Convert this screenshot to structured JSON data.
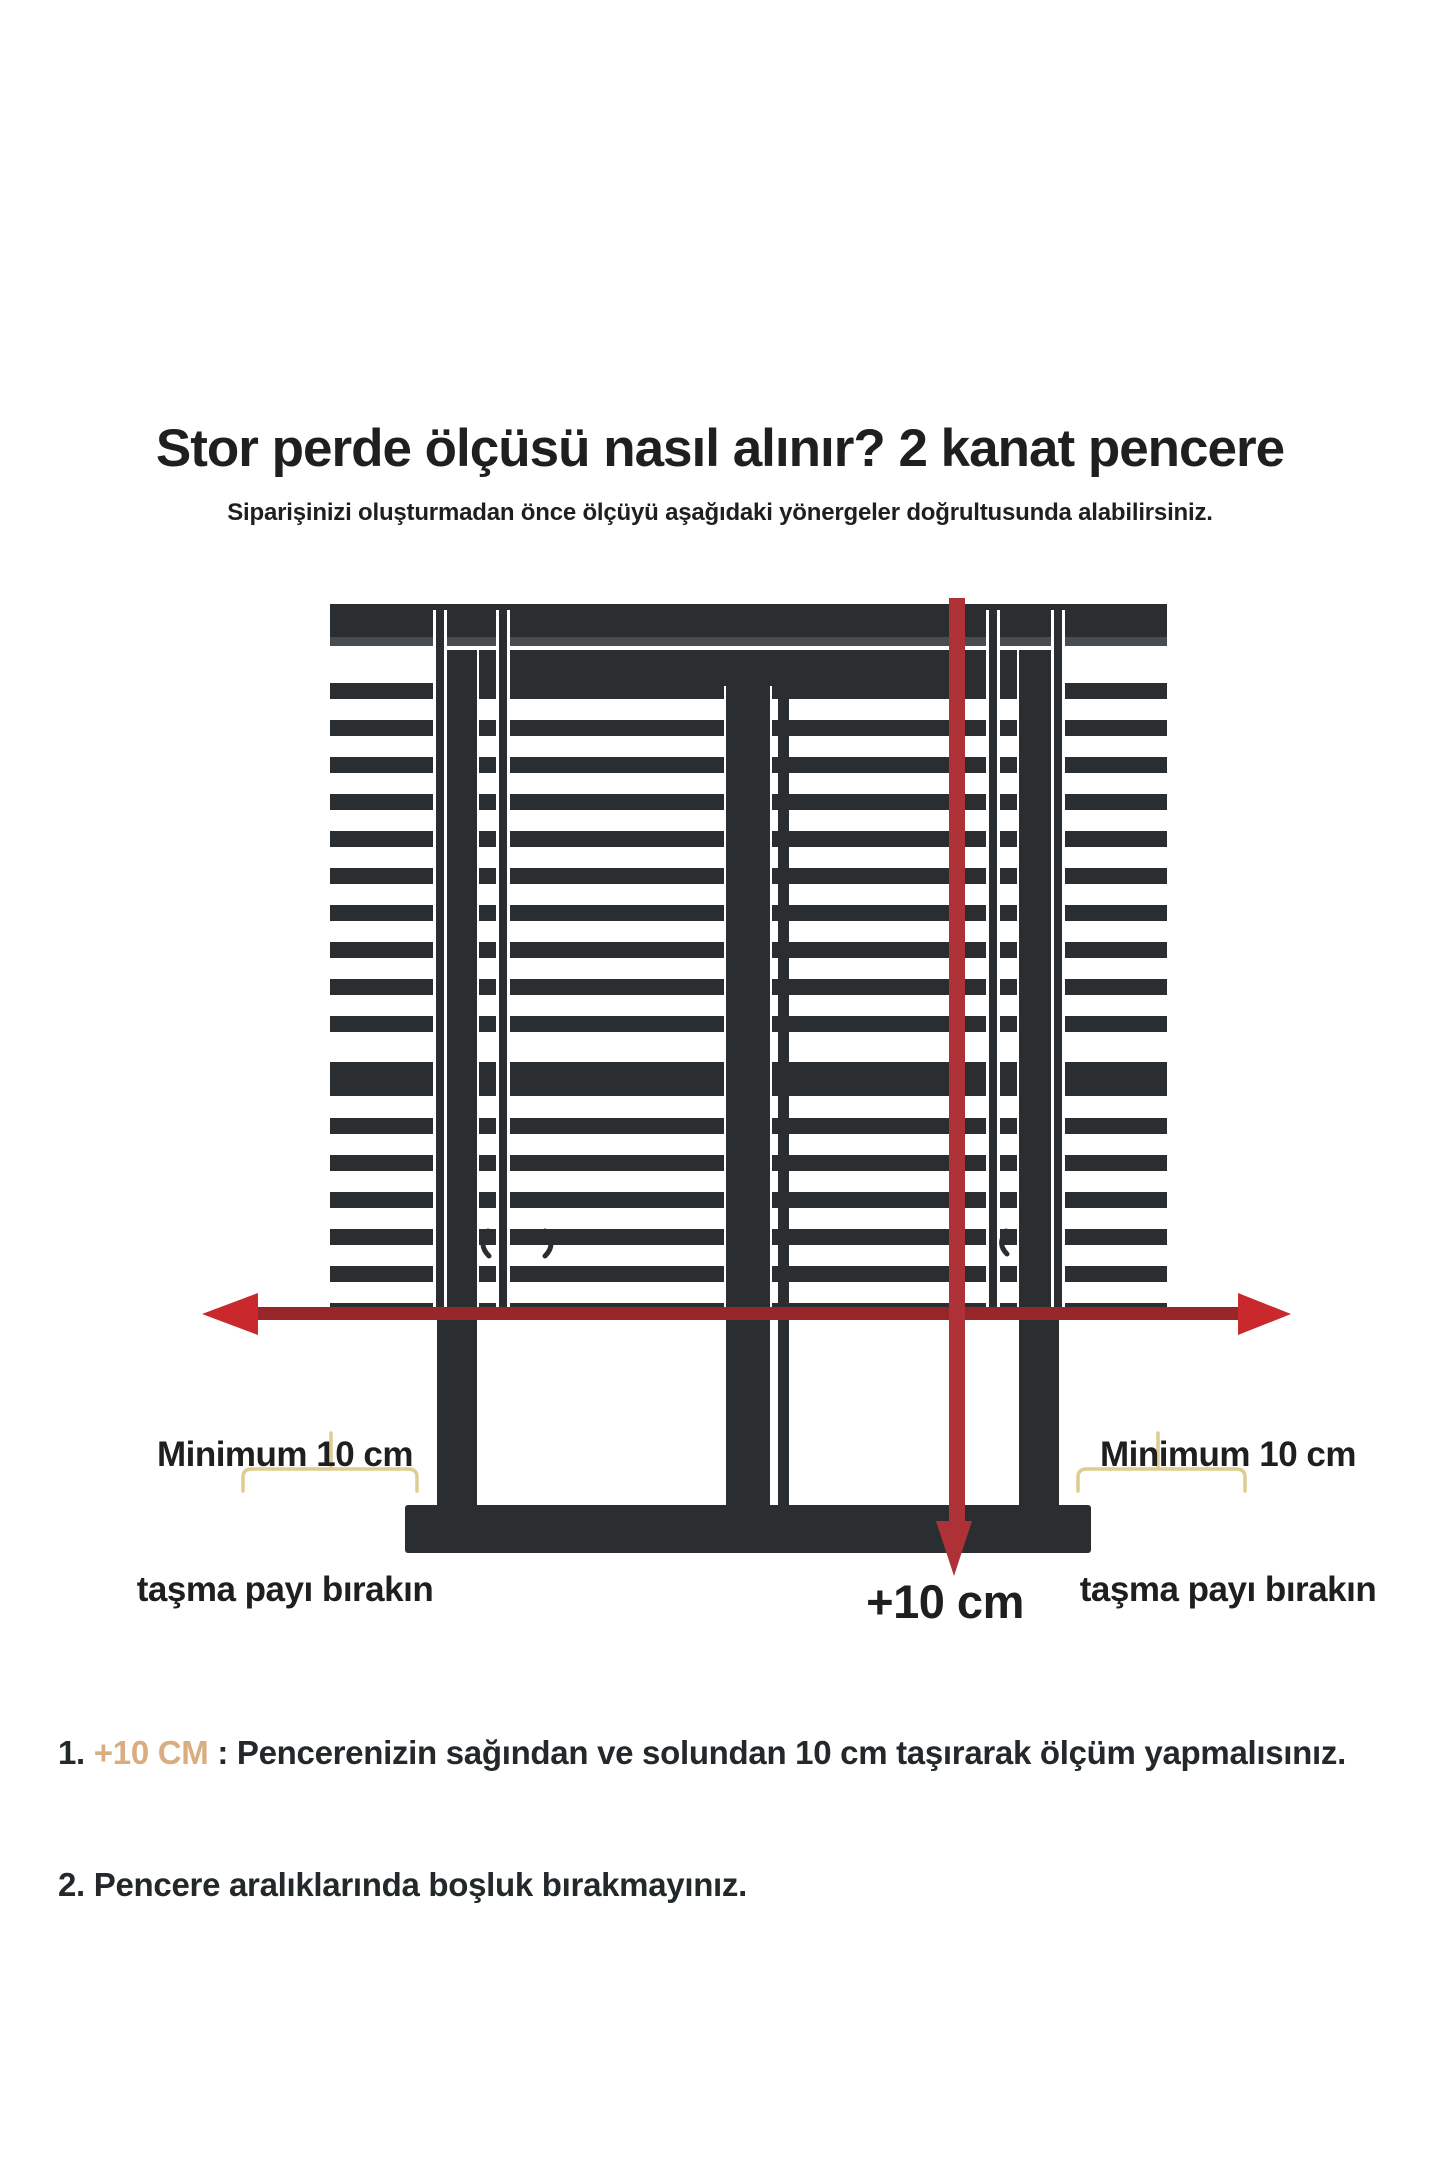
{
  "header": {
    "title": "Stor perde ölçüsü nasıl alınır? 2 kanat pencere",
    "subtitle": "Siparişinizi oluşturmadan önce ölçüyü aşağıdaki yönergeler doğrultusunda alabilirsiniz."
  },
  "diagram": {
    "left_overhang": {
      "line1": "Minimum 10 cm",
      "line2": "taşma payı bırakın"
    },
    "right_overhang": {
      "line1": "Minimum 10 cm",
      "line2": "taşma payı bırakın"
    },
    "bottom_measure": "+10 cm"
  },
  "notes": {
    "item1": {
      "number": "1. ",
      "highlight": "+10 CM",
      "text": " : Pencerenizin sağından ve solundan 10 cm taşırarak ölçüm yapmalısınız."
    },
    "item2": {
      "number": "2. ",
      "text": "Pencere aralıklarında boşluk bırakmayınız."
    }
  },
  "colors": {
    "background": "#ffffff",
    "frame_dark": "#2a2e31",
    "frame_edge_light": "#474c50",
    "red_vertical": "#ad3136",
    "red_shaft": "#97262a",
    "red_head": "#c9282d",
    "bracket_yellow": "#dbce90",
    "text_dark": "#1f1f1f",
    "note_text": "#23282b",
    "note_highlight": "#d9ad80"
  }
}
